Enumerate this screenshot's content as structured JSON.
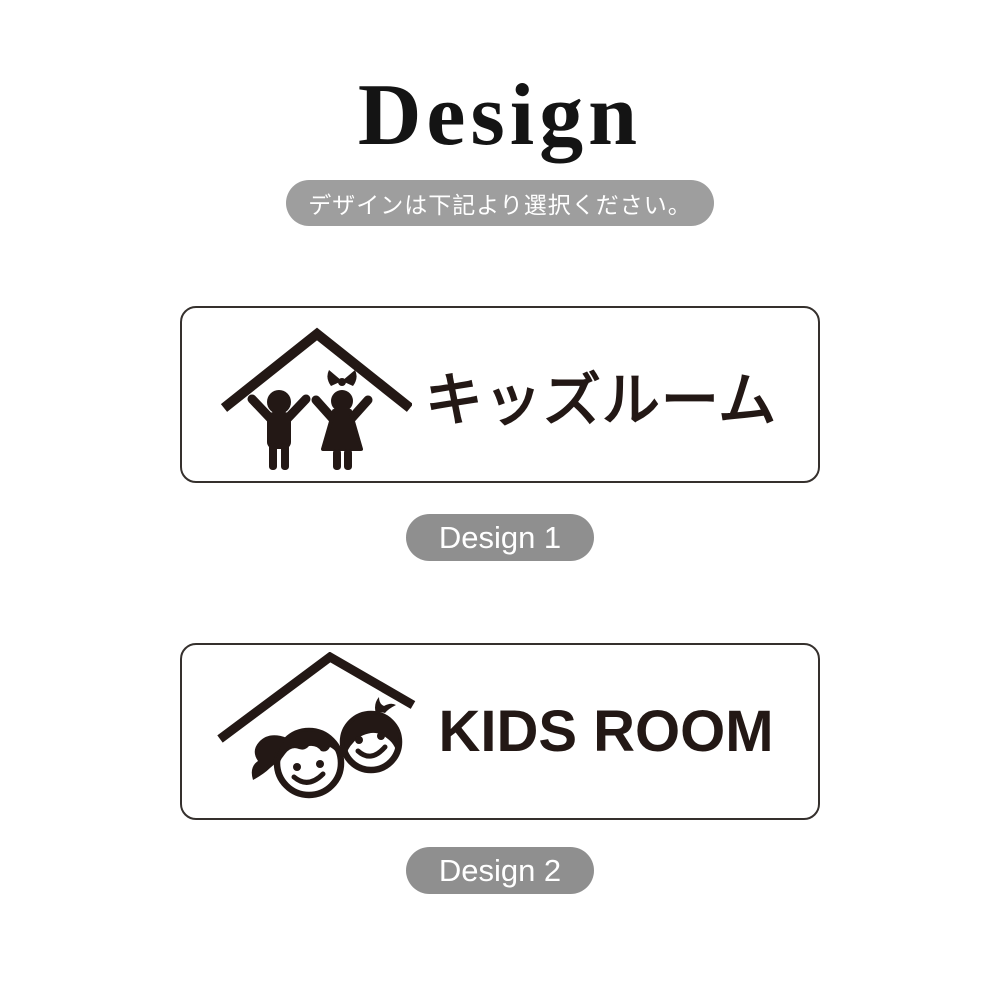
{
  "header": {
    "title": "Design",
    "note": "デザインは下記より選択ください。"
  },
  "designs": [
    {
      "label": "Design 1",
      "sign_text": "キッズルーム",
      "icon": "children-under-roof-icon"
    },
    {
      "label": "Design 2",
      "sign_text": "KIDS ROOM",
      "icon": "kids-faces-under-roof-icon"
    }
  ],
  "colors": {
    "ink": "#231815",
    "note_badge_bg": "#9e9e9e",
    "pill_bg": "#8f8f8f",
    "card_border": "#35302d",
    "background": "#ffffff",
    "badge_text": "#ffffff"
  }
}
